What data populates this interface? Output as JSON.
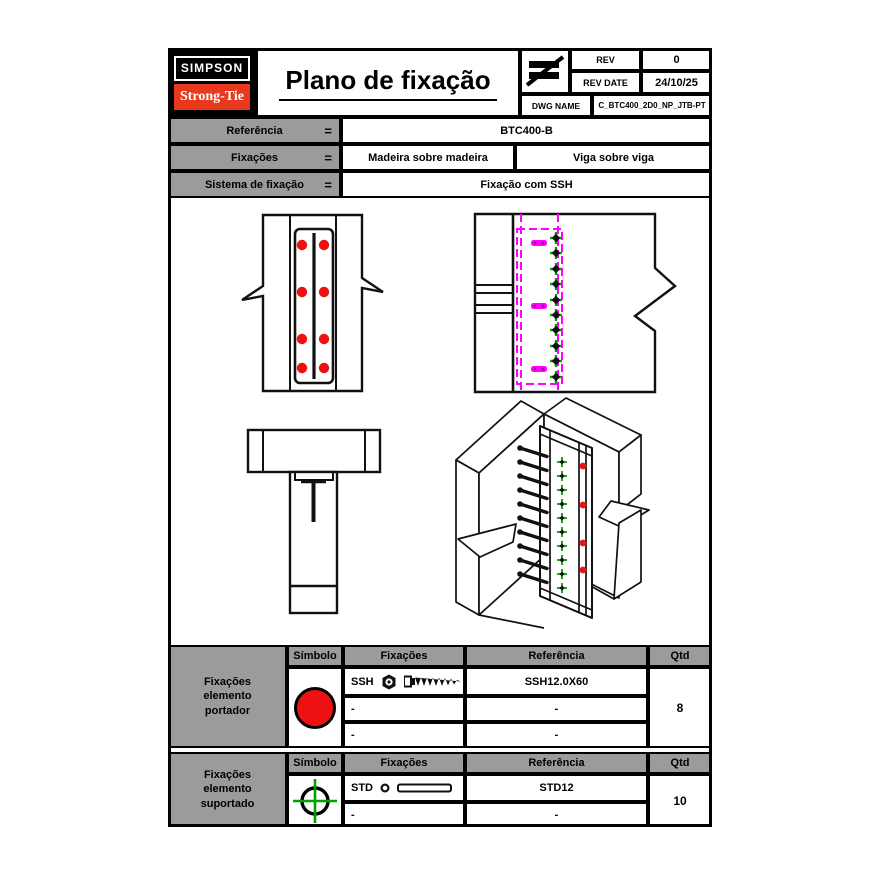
{
  "header": {
    "logo_top": "SIMPSON",
    "logo_bottom": "Strong-Tie",
    "title": "Plano de fixação",
    "rev": {
      "label": "REV",
      "value": "0"
    },
    "rev_date": {
      "label": "REV DATE",
      "value": "24/10/25"
    },
    "dwg_name": {
      "label": "DWG NAME",
      "value": "C_BTC400_2D0_NP_JTB-PT"
    }
  },
  "reference_table": {
    "equals": "=",
    "rows": [
      {
        "label": "Referência",
        "values": [
          "BTC400-B"
        ]
      },
      {
        "label": "Fixações",
        "values": [
          "Madeira sobre madeira",
          "Viga sobre viga"
        ]
      },
      {
        "label": "Sistema de fixação",
        "values": [
          "Fixação com SSH"
        ]
      }
    ]
  },
  "fastener_tables": [
    {
      "group_label": "Fixações elemento portador",
      "headers": [
        "Símbolo",
        "Fixações",
        "Referência",
        "Qtd"
      ],
      "symbol_icon": "red-filled-circle-icon",
      "rows": [
        {
          "fixacao": "SSH",
          "fixacao_icons": [
            "hex-nut-icon",
            "wood-screw-icon"
          ],
          "referencia": "SSH12.0X60"
        },
        {
          "fixacao": "-",
          "referencia": "-"
        },
        {
          "fixacao": "-",
          "referencia": "-"
        }
      ],
      "qty": "8"
    },
    {
      "group_label": "Fixações elemento suportado",
      "headers": [
        "Símbolo",
        "Fixações",
        "Referência",
        "Qtd"
      ],
      "symbol_icon": "green-crosshair-circle-icon",
      "rows": [
        {
          "fixacao": "STD",
          "fixacao_icons": [
            "washer-icon",
            "dowel-icon"
          ],
          "referencia": "STD12"
        },
        {
          "fixacao": "-",
          "referencia": "-"
        }
      ],
      "qty": "10"
    }
  ],
  "drawing_area": {
    "views": [
      "front-view-connector-screws",
      "side-view-hidden-connector",
      "top-plan-view",
      "isometric-connection-view"
    ]
  },
  "colors": {
    "header_gray": "#9b9b9b",
    "logo_red": "#e8391d",
    "fastener_red": "#ee1111",
    "hidden_magenta": "#ff00ff",
    "dowel_green": "#00a000"
  }
}
